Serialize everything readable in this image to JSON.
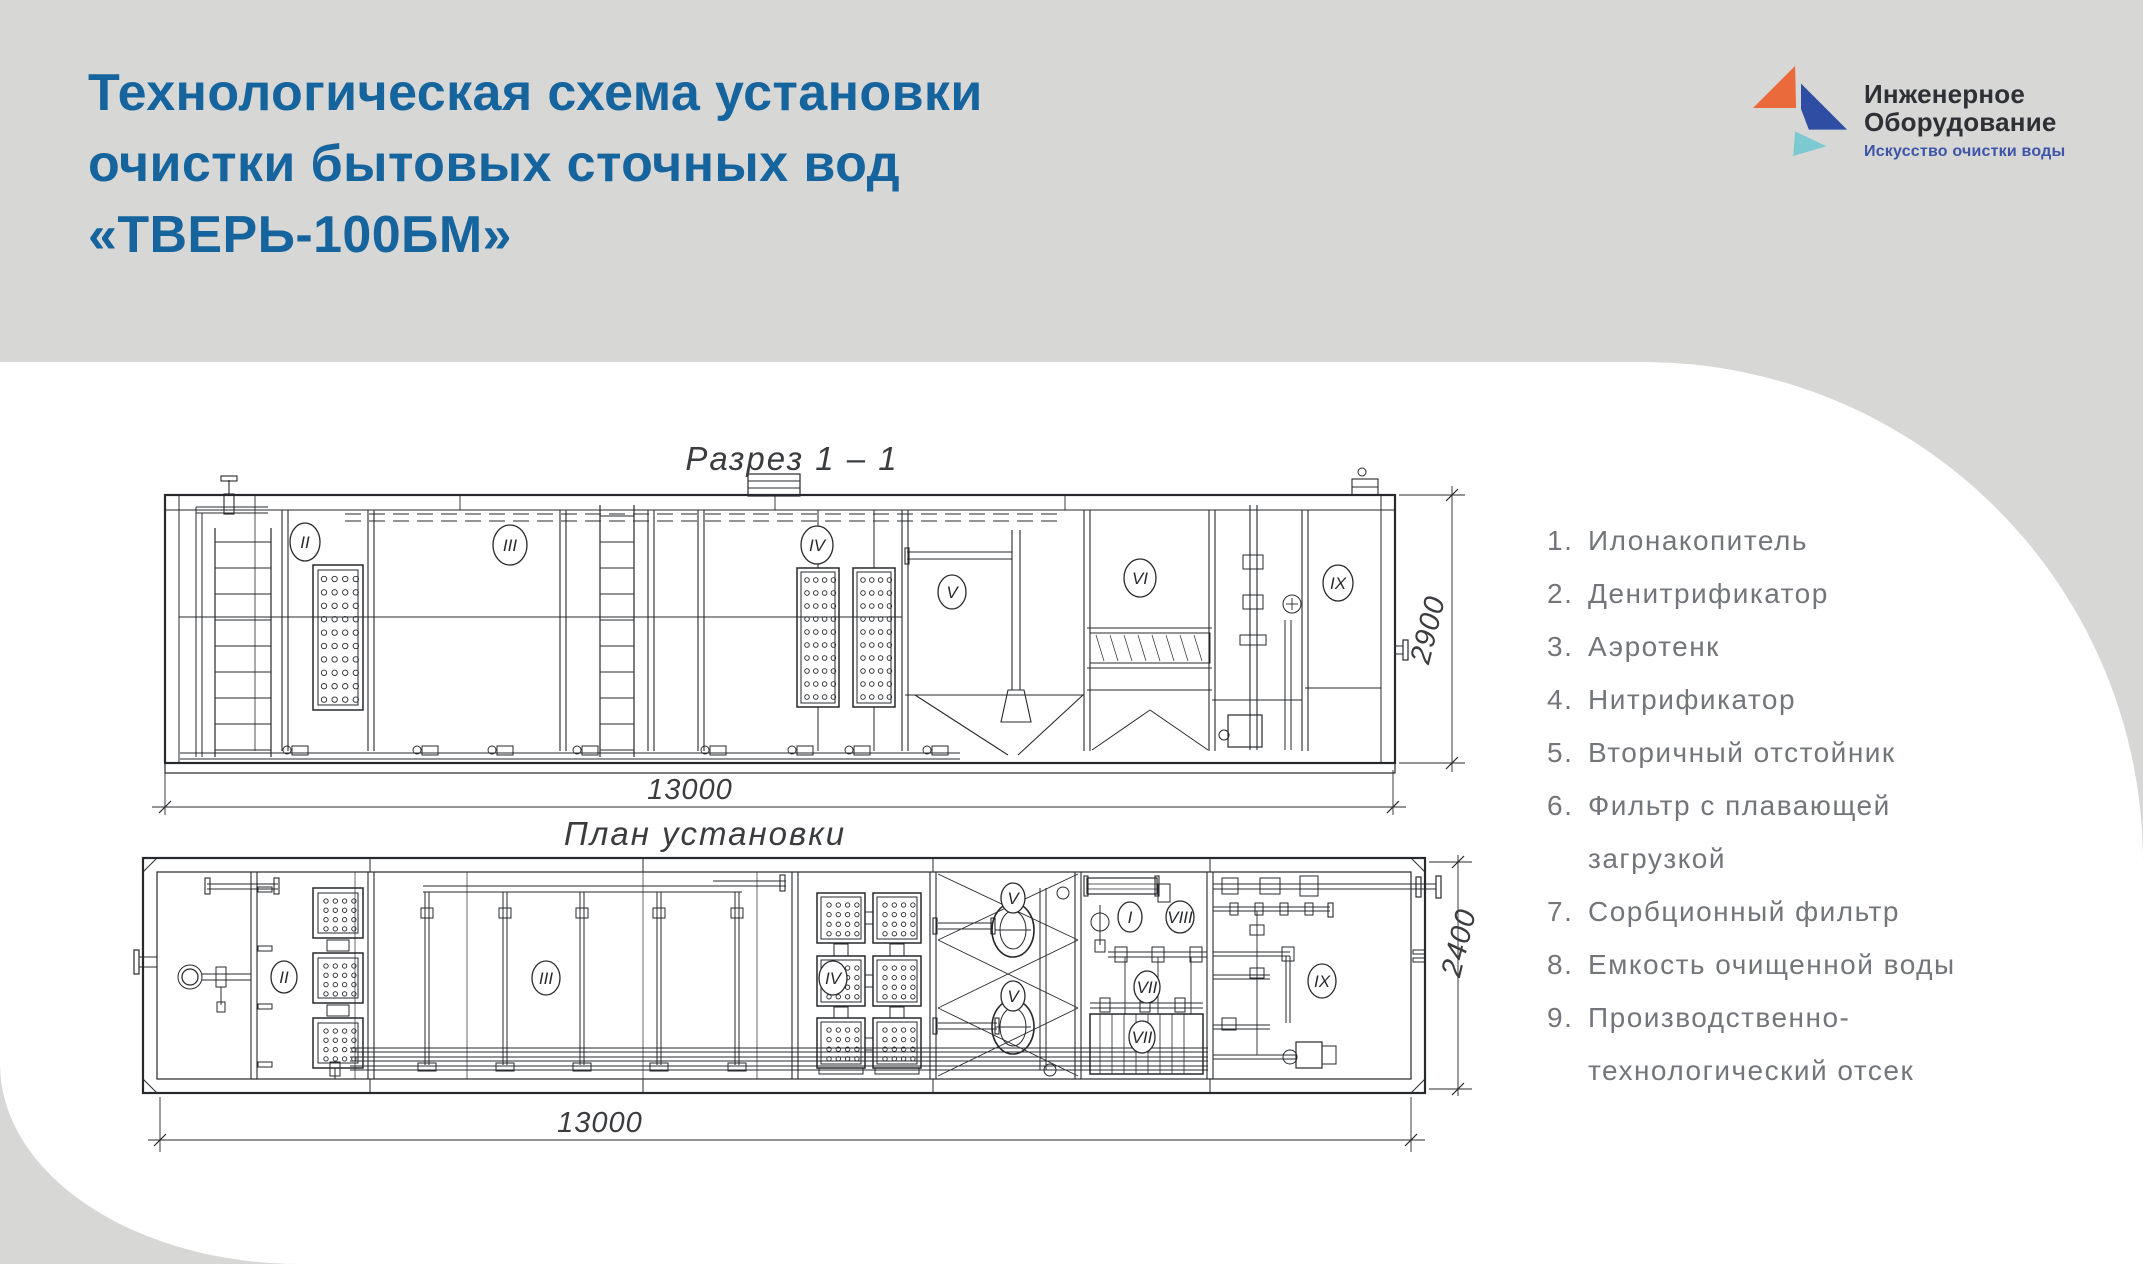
{
  "header": {
    "title_lines": [
      "Технологическая схема установки",
      "очистки бытовых сточных вод",
      "«ТВЕРЬ-100БМ»"
    ]
  },
  "logo": {
    "name_line1": "Инженерное",
    "name_line2": "Оборудование",
    "tagline": "Искусство очистки воды",
    "colors": {
      "orange": "#EB6A3B",
      "blue": "#2F4DA2",
      "teal": "#7CC9D1",
      "tagline_blue": "#3D55A8"
    }
  },
  "drawings": {
    "section": {
      "title": "Разрез 1 – 1",
      "width_dim": "13000",
      "height_dim": "2900",
      "labels": {
        "II": "II",
        "III": "III",
        "IV": "IV",
        "V": "V",
        "VI": "VI",
        "IX": "IX"
      }
    },
    "plan": {
      "title": "План установки",
      "width_dim": "13000",
      "height_dim": "2400",
      "labels": {
        "I": "I",
        "II": "II",
        "III": "III",
        "IV": "IV",
        "V1": "V",
        "V2": "V",
        "VII1": "VII",
        "VII2": "VII",
        "VIII": "VIII",
        "IX": "IX"
      }
    }
  },
  "legend": {
    "items": [
      {
        "num": "1.",
        "text": "Илонакопитель"
      },
      {
        "num": "2.",
        "text": "Денитрификатор"
      },
      {
        "num": "3.",
        "text": "Аэротенк"
      },
      {
        "num": "4.",
        "text": "Нитрификатор"
      },
      {
        "num": "5.",
        "text": "Вторичный отстойник"
      },
      {
        "num": "6.",
        "text": "Фильтр с плавающей загрузкой"
      },
      {
        "num": "7.",
        "text": "Сорбционный фильтр"
      },
      {
        "num": "8.",
        "text": "Емкость очищенной воды"
      },
      {
        "num": "9.",
        "text": "Производственно-технологический отсек"
      }
    ]
  }
}
